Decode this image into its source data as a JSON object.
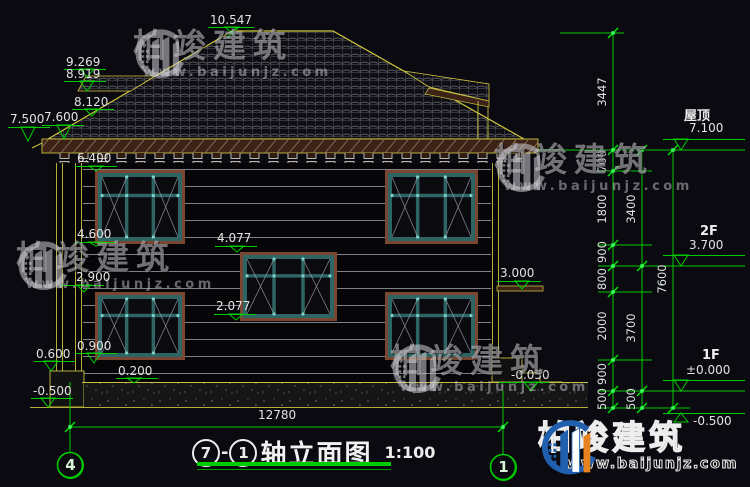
{
  "title_block": {
    "axis_from": "7",
    "separator": "-",
    "axis_to": "1",
    "title": "轴立面图",
    "scale": "1:100"
  },
  "axis_bubbles": {
    "left": "4",
    "right": "1"
  },
  "floor_labels": [
    "屋顶",
    "2F",
    "1F"
  ],
  "bottom_dimension": "12780",
  "watermark": {
    "brand": "柏竣建筑",
    "url": "www.baijunjz.com"
  },
  "annotations": [
    {
      "t": "10.547",
      "x": 210,
      "y": 14,
      "ax": 232,
      "ay": 33,
      "l": [
        208,
        254,
        27
      ]
    },
    {
      "t": "9.269",
      "x": 66,
      "y": 56,
      "ax": 87,
      "ay": 77,
      "l": [
        64,
        106,
        69
      ]
    },
    {
      "t": "8.919",
      "x": 66,
      "y": 68,
      "ax": 87,
      "ay": 91,
      "l": [
        64,
        106,
        81
      ]
    },
    {
      "t": "8.120",
      "x": 74,
      "y": 96,
      "ax": 92,
      "ay": 116,
      "l": [
        72,
        114,
        109
      ]
    },
    {
      "t": "7.500",
      "x": 10,
      "y": 113,
      "ax": 28,
      "ay": 141,
      "l": [
        8,
        50,
        127
      ]
    },
    {
      "t": "7.600",
      "x": 44,
      "y": 111,
      "ax": 64,
      "ay": 139,
      "l": [
        42,
        84,
        125
      ]
    },
    {
      "t": "6.400",
      "x": 77,
      "y": 152,
      "ax": 96,
      "ay": 171,
      "l": [
        75,
        117,
        166
      ]
    },
    {
      "t": "4.600",
      "x": 77,
      "y": 228,
      "ax": 96,
      "ay": 246,
      "l": [
        75,
        117,
        242
      ]
    },
    {
      "t": "4.077",
      "x": 217,
      "y": 232,
      "ax": 237,
      "ay": 252,
      "l": [
        215,
        257,
        246
      ]
    },
    {
      "t": "2.900",
      "x": 76,
      "y": 271,
      "ax": 84,
      "ay": 292,
      "l": [
        60,
        104,
        285
      ]
    },
    {
      "t": "2.077",
      "x": 216,
      "y": 300,
      "ax": 236,
      "ay": 320,
      "l": [
        214,
        256,
        314
      ]
    },
    {
      "t": "0.900",
      "x": 77,
      "y": 340,
      "ax": 94,
      "ay": 363,
      "l": [
        75,
        117,
        353
      ]
    },
    {
      "t": "0.600",
      "x": 36,
      "y": 348,
      "ax": 51,
      "ay": 371,
      "l": [
        34,
        76,
        361
      ]
    },
    {
      "t": "0.200",
      "x": 118,
      "y": 365,
      "ax": 134,
      "ay": 383,
      "l": [
        116,
        158,
        378
      ]
    },
    {
      "t": "-0.500",
      "x": 33,
      "y": 385,
      "ax": 48,
      "ay": 407,
      "l": [
        31,
        73,
        398
      ]
    },
    {
      "t": "3.000",
      "x": 500,
      "y": 267,
      "ax": 522,
      "ay": 289,
      "l": [
        497,
        541,
        281
      ]
    },
    {
      "t": "-0.050",
      "x": 511,
      "y": 369,
      "ax": 531,
      "ay": 391,
      "l": [
        499,
        549,
        382
      ]
    },
    {
      "t": "7.100",
      "x": 689,
      "y": 122,
      "ax": 681,
      "ay": 150,
      "l": [
        663,
        745,
        139
      ]
    },
    {
      "t": "3.700",
      "x": 689,
      "y": 239,
      "ax": 681,
      "ay": 266,
      "l": [
        663,
        745,
        255
      ]
    },
    {
      "t": "±0.000",
      "x": 686,
      "y": 364,
      "ax": 681,
      "ay": 391,
      "l": [
        663,
        745,
        380
      ]
    },
    {
      "t": "-0.500",
      "x": 693,
      "y": 415,
      "ax": 681,
      "ay": 413,
      "inv": true,
      "l": [
        663,
        745,
        413
      ]
    }
  ],
  "vertical_dims": [
    {
      "t": "3447",
      "x": 602,
      "y": 92
    },
    {
      "t": "700",
      "x": 602,
      "y": 161
    },
    {
      "t": "1800",
      "x": 602,
      "y": 209
    },
    {
      "t": "900",
      "x": 602,
      "y": 252
    },
    {
      "t": "800",
      "x": 602,
      "y": 279
    },
    {
      "t": "2000",
      "x": 602,
      "y": 326
    },
    {
      "t": "900",
      "x": 602,
      "y": 374
    },
    {
      "t": "500",
      "x": 602,
      "y": 399
    },
    {
      "t": "3400",
      "x": 631,
      "y": 209
    },
    {
      "t": "3700",
      "x": 631,
      "y": 328
    },
    {
      "t": "500",
      "x": 631,
      "y": 399
    },
    {
      "t": "7600",
      "x": 662,
      "y": 279
    }
  ],
  "colors": {
    "line_green": "#00cc00",
    "cad_yellow": "#c8c040",
    "dim_text": "#e3e3e3",
    "eave_brown": "#3c2217",
    "window_frame_brown": "#7a4632",
    "window_teal": "#2f6464",
    "logo_blue": "#1f5fae",
    "logo_orange": "#e8821e"
  }
}
